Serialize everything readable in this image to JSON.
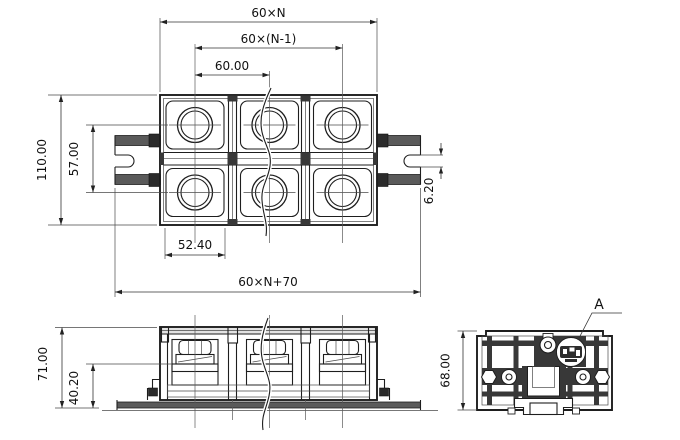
{
  "drawing": {
    "type": "engineering-outline-drawing",
    "subject": "DIN-rail mounted multi-pole terminal block, three orthographic views",
    "colors": {
      "line": "#1e1e1e",
      "hatch": "#5a5a5a",
      "background": "#ffffff"
    },
    "views": {
      "top": {
        "dimensions": {
          "total_pitch": "60×N",
          "pitch_n_minus_1": "60×(N-1)",
          "pole_pitch": "60.00",
          "body_depth": "110.00",
          "row_span": "57.00",
          "opening_width": "52.40",
          "slot_width": "6.20",
          "overall_length": "60×N+70"
        }
      },
      "front": {
        "dimensions": {
          "overall_height": "71.00",
          "contact_height": "40.20"
        }
      },
      "end": {
        "dimensions": {
          "body_height": "68.00"
        },
        "detail_label": "A"
      }
    }
  }
}
